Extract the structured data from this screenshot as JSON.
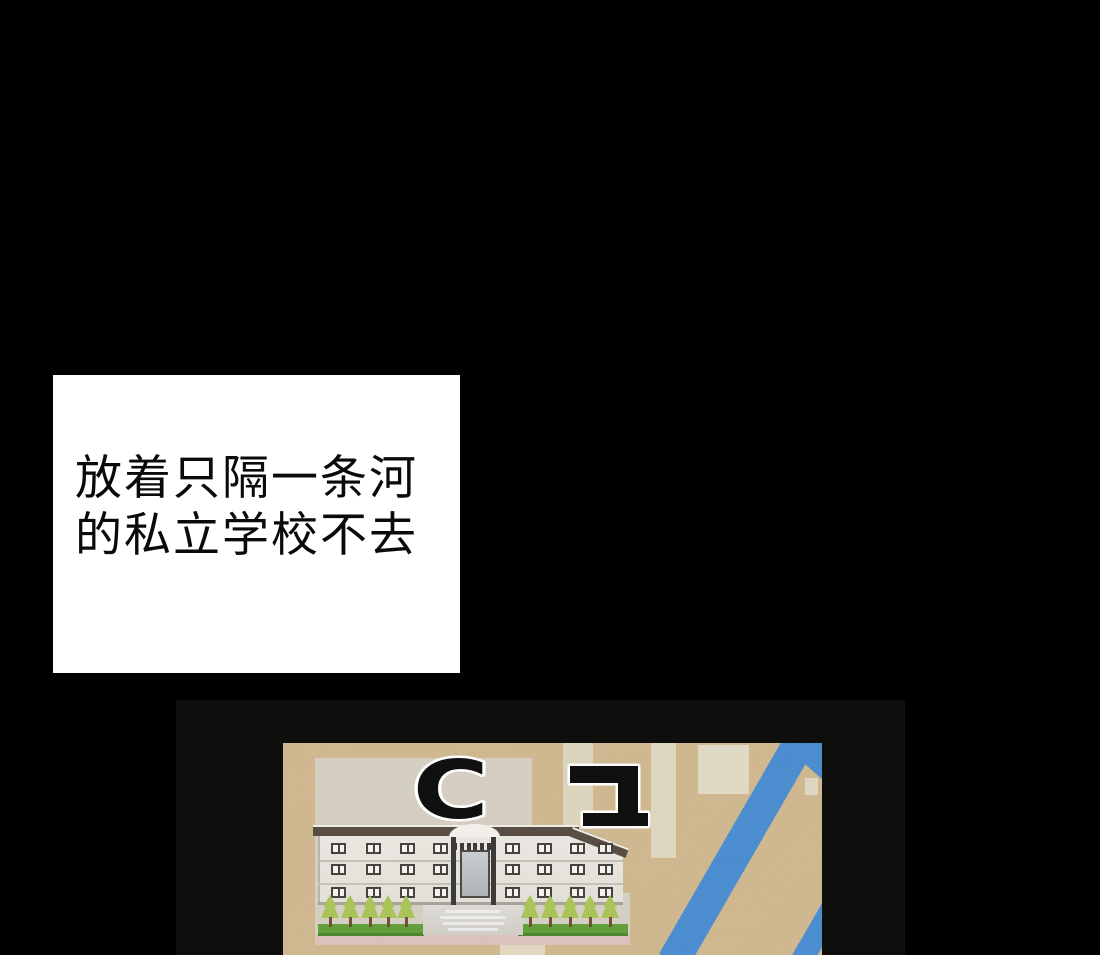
{
  "caption": {
    "lines": [
      "放着只隔一条河",
      "的私立学校不去"
    ]
  },
  "map": {
    "school_label": "C고",
    "school_label_latin": "C",
    "palette": {
      "panel_black": "#0d0d0c",
      "map_tan": "#cfb88f",
      "block_light": "#d5cfc3",
      "road_blue": "#4a8dd0",
      "grass_green": "#61a03b",
      "roof_brown": "#574c41",
      "wall_white": "#eae7e1",
      "strip_pink": "#dbc2ba",
      "caption_bg": "#ffffff",
      "caption_text": "#0a0a0a"
    }
  }
}
